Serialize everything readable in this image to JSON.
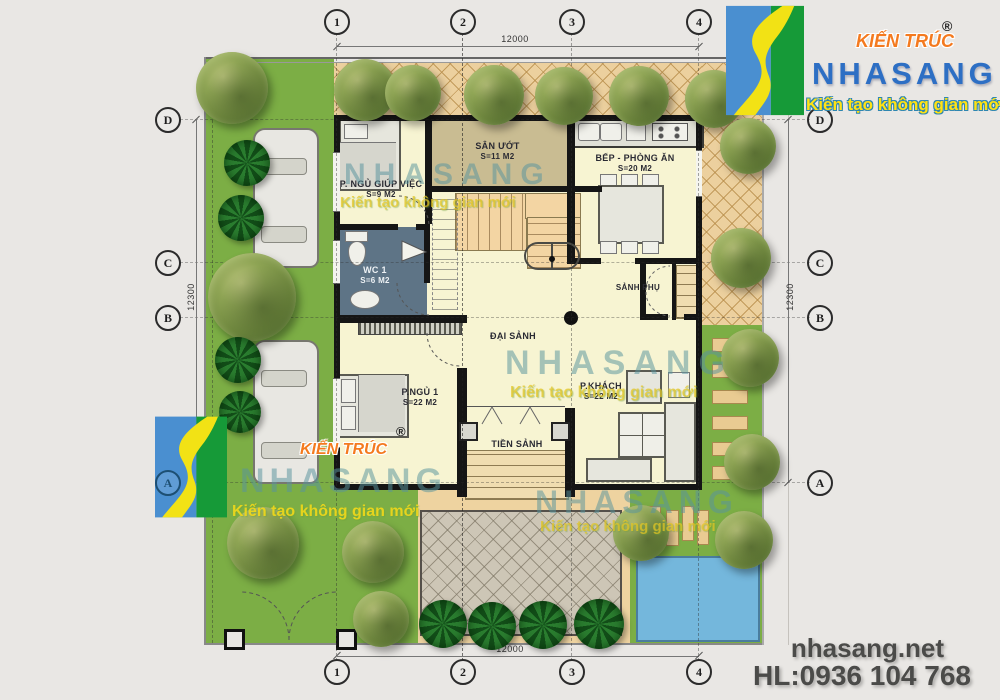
{
  "logo": {
    "kien_truc": "KIẾN TRÚC",
    "reg": "®",
    "name": "NHASANG",
    "tagline": "Kiến tạo không gian mới"
  },
  "watermark": {
    "name": "NHASANG",
    "tagline": "Kiến tạo không gian mới"
  },
  "footer": {
    "website": "nhasang.net",
    "hotline": "HL:0936 104 768"
  },
  "grid": {
    "columns": [
      "1",
      "2",
      "3",
      "4"
    ],
    "rows": [
      "D",
      "C",
      "B",
      "A"
    ]
  },
  "dims": {
    "top": "12000",
    "bottom": "12000",
    "left": "12300",
    "right": "12300"
  },
  "rooms": {
    "maid": {
      "name": "P. NGỦ GIÚP VIỆC",
      "area": "S=9 M2"
    },
    "sanuot": {
      "name": "SÂN ƯỚT",
      "area": "S=11 M2"
    },
    "bep": {
      "name": "BẾP - PHÒNG ĂN",
      "area": "S=20 M2"
    },
    "wc": {
      "name": "WC 1",
      "area": "S=6 M2"
    },
    "daisanh": {
      "name": "ĐẠI SẢNH"
    },
    "sanhphu": {
      "name": "SẢNH PHỤ"
    },
    "ngu1": {
      "name": "P.NGỦ 1",
      "area": "S=22 M2"
    },
    "khach": {
      "name": "P.KHÁCH",
      "area": "S=22 M2"
    },
    "tiensanh": {
      "name": "TIỀN SẢNH"
    }
  }
}
